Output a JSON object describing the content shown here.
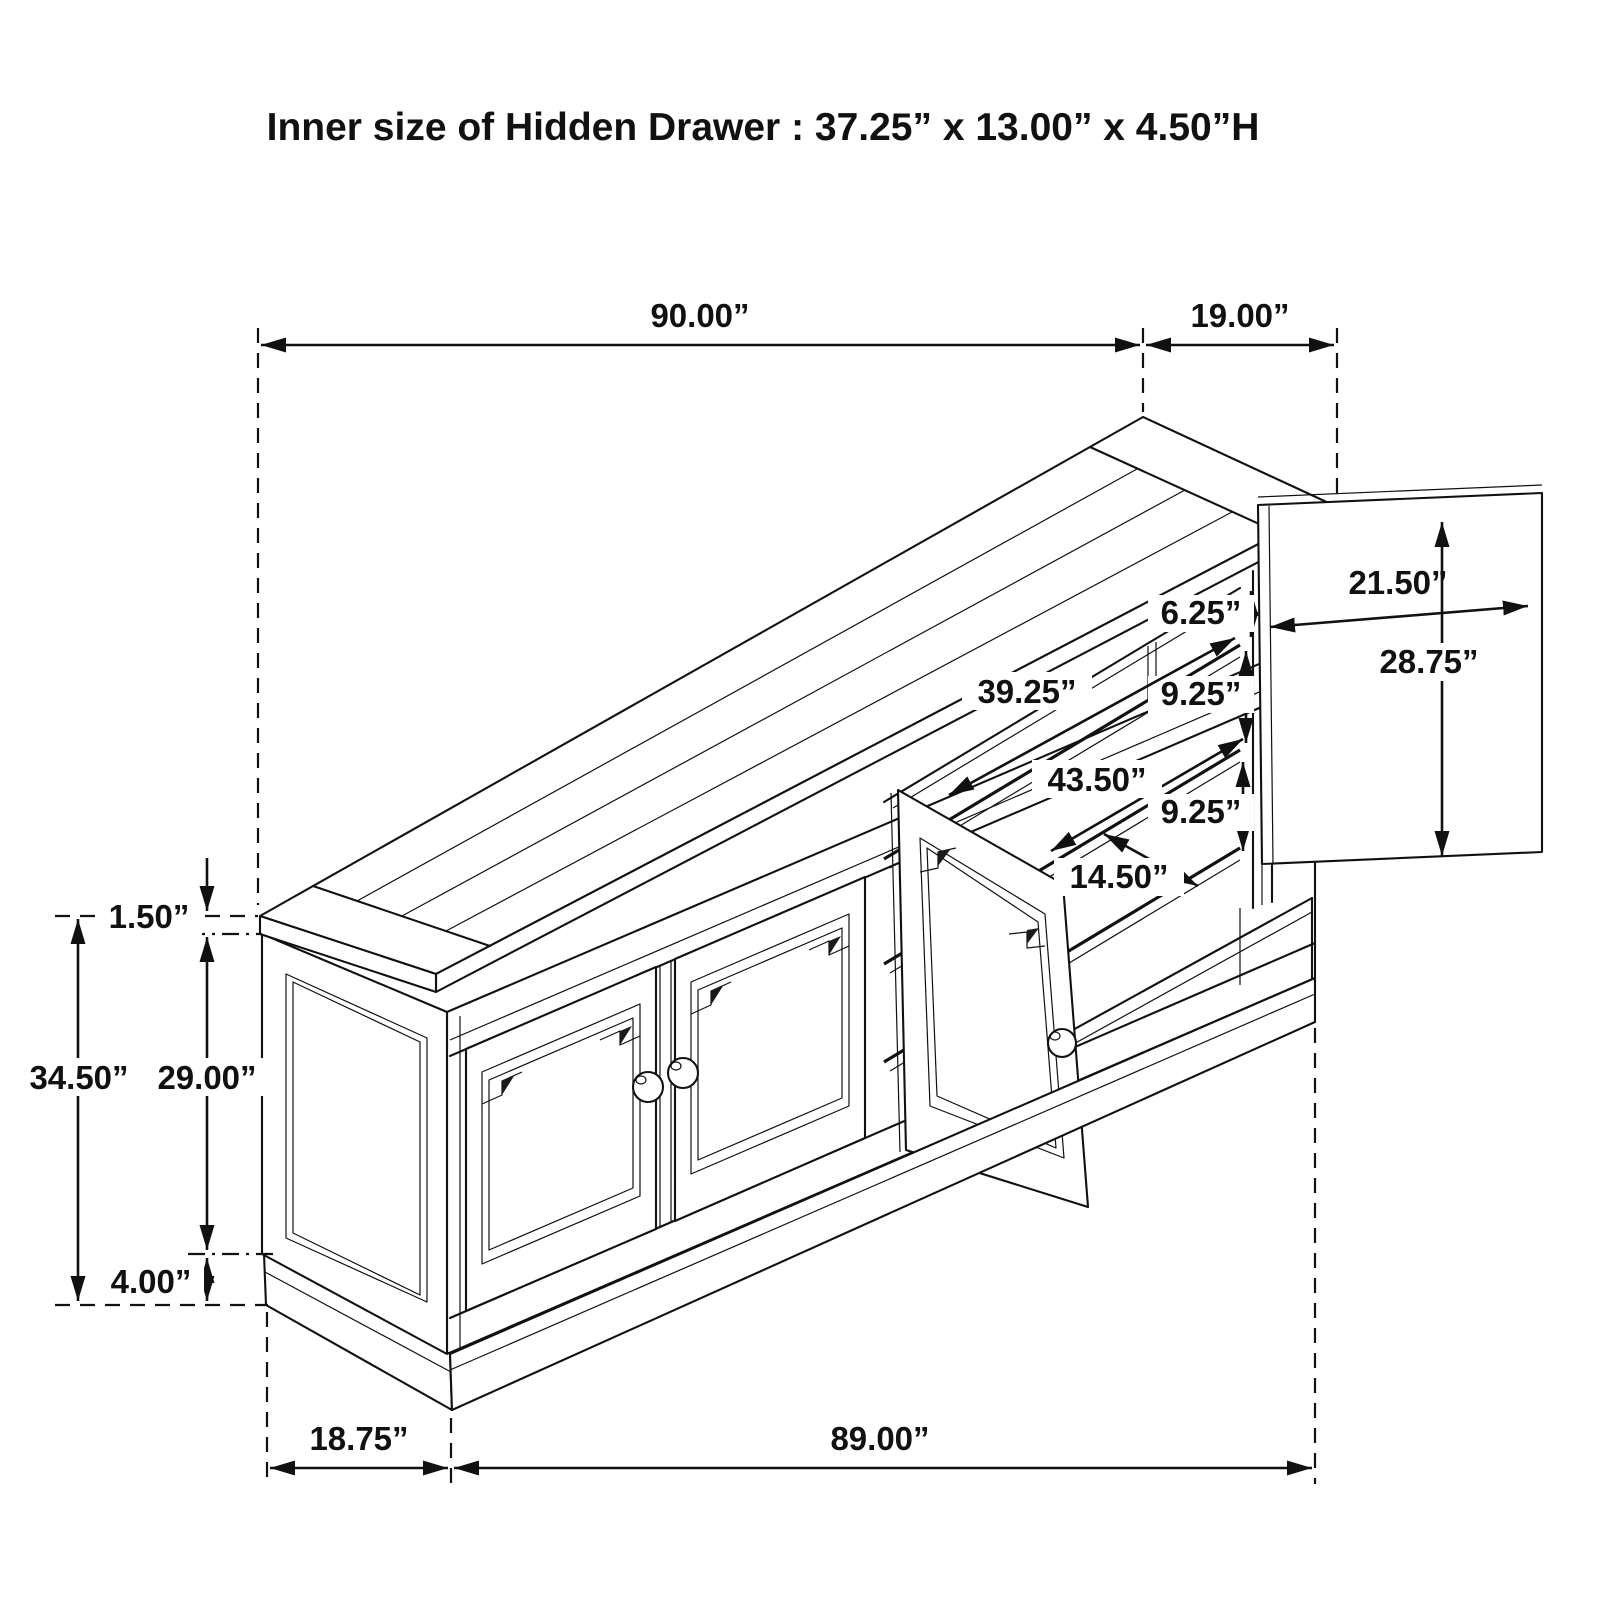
{
  "title": "Inner size of Hidden Drawer : 37.25” x 13.00” x 4.50”H",
  "drawing_type": "sideboard-dimension-diagram",
  "colors": {
    "ink": "#111111",
    "background": "#ffffff"
  },
  "dimensions": {
    "top_length": "90.00”",
    "side_door_width": "19.00”",
    "side_door_panel_width": "21.50”",
    "side_door_panel_height": "28.75”",
    "top_shelf_space": "6.25”",
    "upper_shelf_length": "39.25”",
    "middle_shelf_space": "9.25”",
    "lower_shelf_length": "43.50”",
    "bottom_shelf_space": "9.25”",
    "drawer_front_depth": "14.50”",
    "top_thickness": "1.50”",
    "overall_height": "34.50”",
    "door_opening_height": "29.00”",
    "base_height": "4.00”",
    "side_depth": "18.75”",
    "body_length": "89.00”"
  }
}
